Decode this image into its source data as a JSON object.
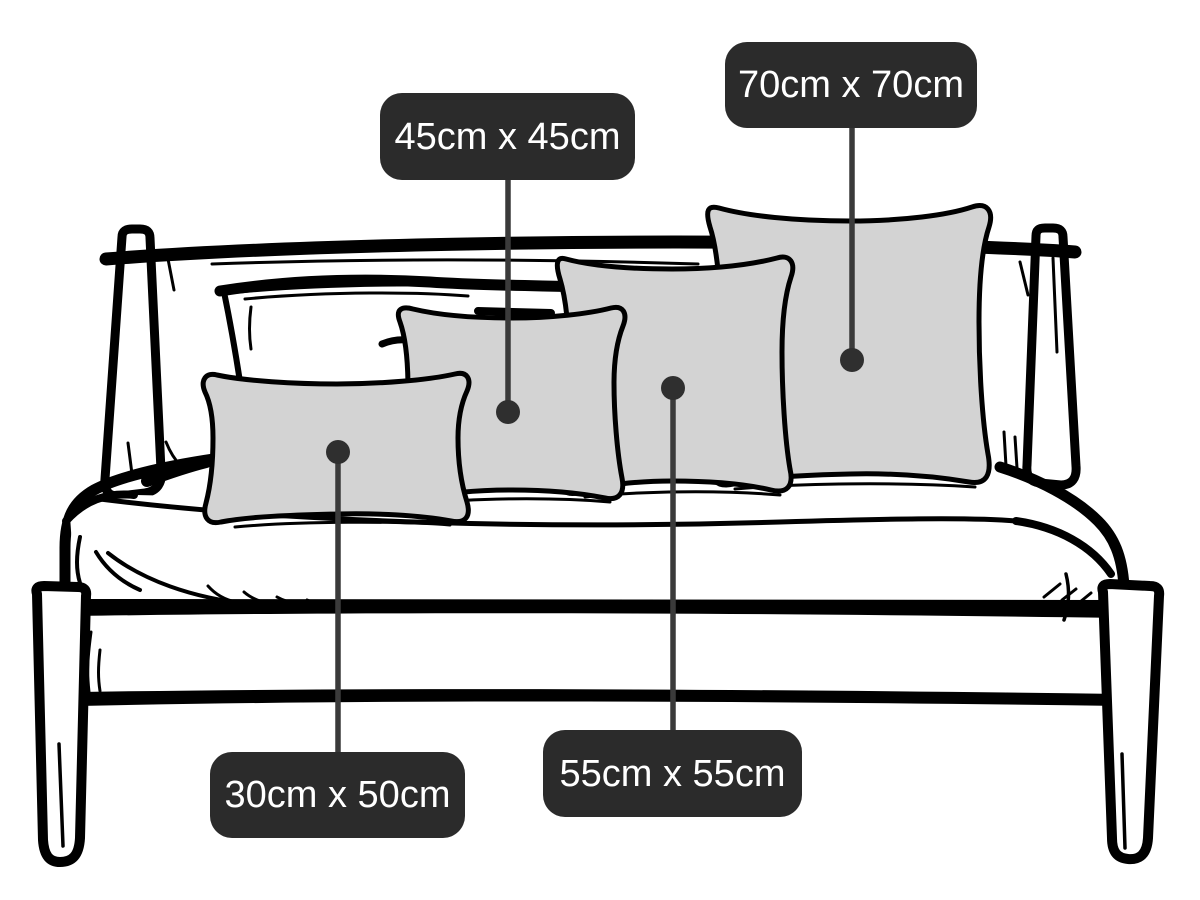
{
  "colors": {
    "background": "#ffffff",
    "line_art": "#000000",
    "cushion_fill": "#d3d3d3",
    "callout_line": "#3a3a3a",
    "callout_dot": "#2f2f2f",
    "label_bg": "#2b2b2b",
    "label_text": "#ffffff"
  },
  "annotations": [
    {
      "id": "30x50",
      "label": "30cm x 50cm",
      "direction": "down",
      "dot": {
        "x": 338,
        "y": 452
      },
      "label_box": {
        "x": 210,
        "y": 752,
        "w": 255,
        "h": 86
      }
    },
    {
      "id": "45x45",
      "label": "45cm x 45cm",
      "direction": "up",
      "dot": {
        "x": 508,
        "y": 412
      },
      "label_box": {
        "x": 380,
        "y": 93,
        "w": 255,
        "h": 87
      }
    },
    {
      "id": "55x55",
      "label": "55cm x 55cm",
      "direction": "down",
      "dot": {
        "x": 673,
        "y": 388
      },
      "label_box": {
        "x": 543,
        "y": 730,
        "w": 259,
        "h": 87
      }
    },
    {
      "id": "70x70",
      "label": "70cm x 70cm",
      "direction": "up",
      "dot": {
        "x": 852,
        "y": 360
      },
      "label_box": {
        "x": 725,
        "y": 42,
        "w": 252,
        "h": 86
      }
    }
  ]
}
